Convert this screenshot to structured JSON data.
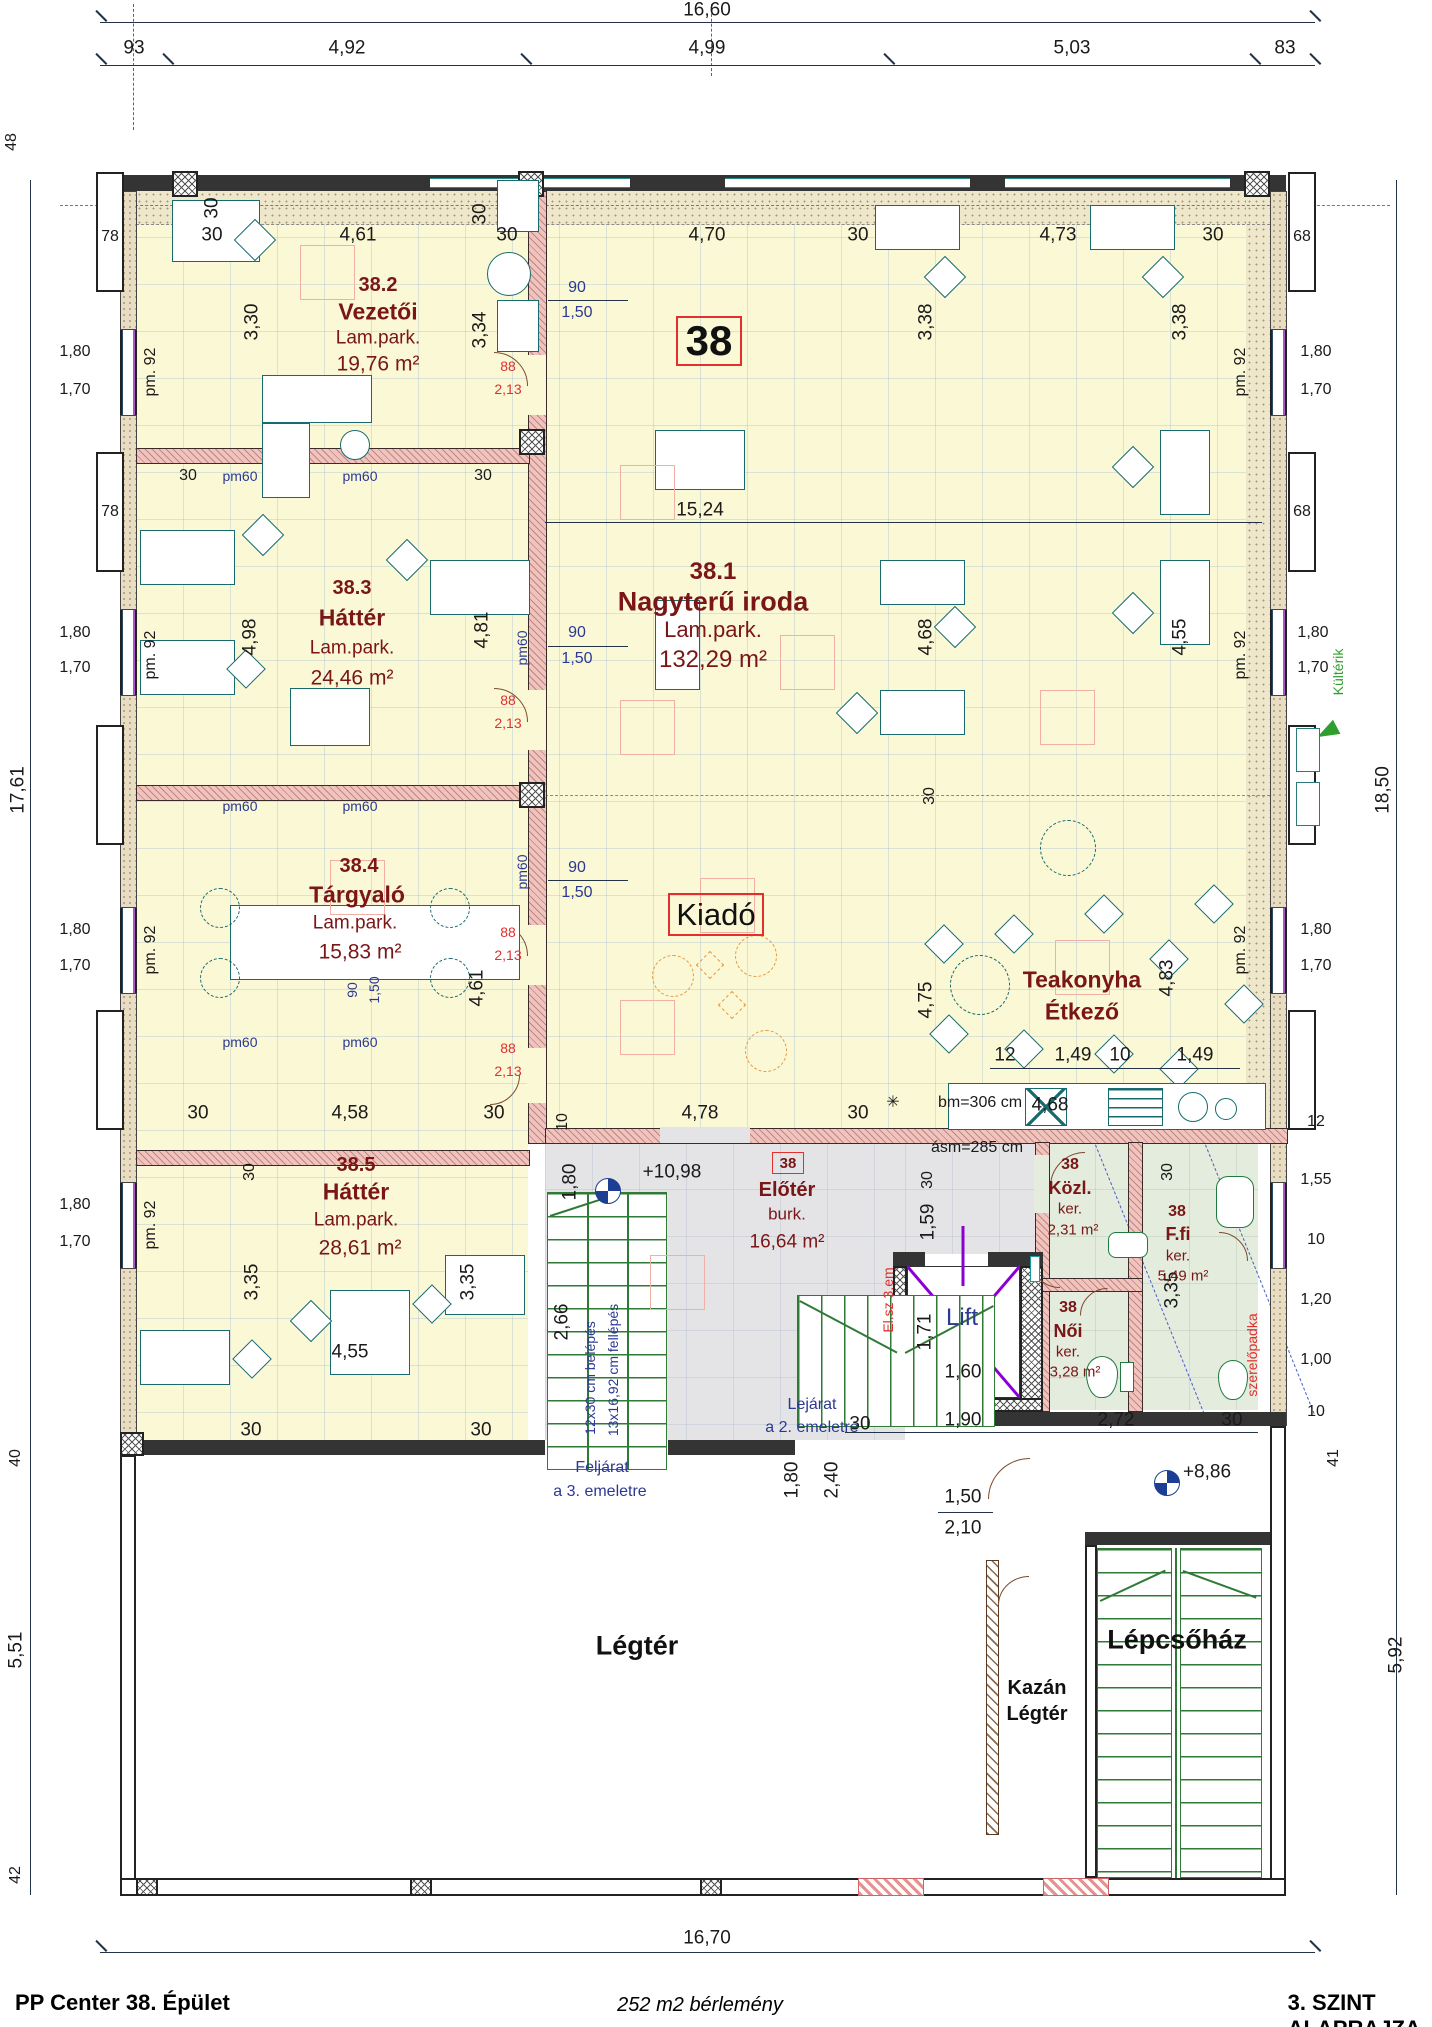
{
  "footer": {
    "left": "PP Center  38. Épület",
    "center": "252 m2 bérlemény",
    "right": "3. SZINT ALAPRAJZA  M=1:100"
  },
  "unit": {
    "big": "38"
  },
  "rooms": {
    "r381": {
      "num": "38.1",
      "name": "Nagyterű iroda",
      "floor": "Lam.park.",
      "area": "132,29 m²"
    },
    "r382": {
      "num": "38.2",
      "name": "Vezetői",
      "floor": "Lam.park.",
      "area": "19,76 m²"
    },
    "r383": {
      "num": "38.3",
      "name": "Háttér",
      "floor": "Lam.park.",
      "area": "24,46 m²"
    },
    "r384": {
      "num": "38.4",
      "name": "Tárgyaló",
      "floor": "Lam.park.",
      "area": "15,83 m²"
    },
    "r385": {
      "num": "38.5",
      "name": "Háttér",
      "floor": "Lam.park.",
      "area": "28,61 m²"
    },
    "kiado": {
      "name": "Kiadó"
    },
    "teakonyha": {
      "line1": "Teakonyha",
      "line2": "Étkező"
    },
    "eloter": {
      "tag": "38",
      "name": "Előtér",
      "floor": "burk.",
      "area": "16,64 m²"
    },
    "kozl": {
      "tag": "38",
      "name": "Közl.",
      "type": "ker.",
      "area": "2,31 m²"
    },
    "noi": {
      "tag": "38",
      "name": "Női",
      "type": "ker.",
      "area": "3,28 m²"
    },
    "ffi": {
      "tag": "38",
      "name": "F.fi",
      "type": "ker.",
      "area": "5,49 m²"
    },
    "lift": {
      "name": "Lift"
    },
    "legter": {
      "name": "Légtér"
    },
    "lepcsohaz": {
      "name": "Lépcsőház"
    },
    "kazan": {
      "line1": "Kazán",
      "line2": "Légtér"
    }
  },
  "dims": {
    "d1660": "16,60",
    "d93": "93",
    "d492": "4,92",
    "d499": "4,99",
    "d503": "5,03",
    "d83": "83",
    "d1670": "16,70",
    "d48": "48",
    "d42": "42",
    "d40": "40",
    "d41": "41",
    "d551": "5,51",
    "d592": "5,92",
    "d1761": "17,61",
    "d1850": "18,50",
    "d78": "78",
    "d68": "68",
    "d180": "1,80",
    "d170": "1,70",
    "d30": "30",
    "d461": "4,61",
    "d330": "3,30",
    "d334": "3,34",
    "d470": "4,70",
    "d473": "4,73",
    "d338": "3,38",
    "d1524": "15,24",
    "d498": "4,98",
    "d481": "4,81",
    "d468": "4,68",
    "d455": "4,55",
    "d475": "4,75",
    "d483": "4,83",
    "d12": "12",
    "d149": "1,49",
    "d10": "10",
    "d155": "1,55",
    "d120": "1,20",
    "d100": "1,00",
    "d458": "4,58",
    "d335": "3,35",
    "d266": "2,66",
    "d478": "4,78",
    "d159": "1,59",
    "d150": "1,50",
    "d210": "2,10",
    "d240": "2,40",
    "d190": "1,90",
    "d272": "2,72",
    "d171": "1,71",
    "d160": "1,60",
    "d90": "90",
    "d88": "88",
    "d213": "2,13"
  },
  "ann": {
    "pm92": "pm. 92",
    "pm60": "pm60",
    "lvl_up": "+10,98",
    "lvl_dn": "+8,86",
    "bm": "bm=306 cm",
    "asm": "ásm=285 cm",
    "felj1": "Feljárat",
    "felj2": "a 3. emeletre",
    "lej1": "Lejárat",
    "lej2": "a 2. emeletre",
    "belepes": "12x30 cm belépés",
    "fellepes": "13x16,92 cm fellépés",
    "kulterik": "Kültérik",
    "elsz": "El.sz 3.em",
    "szerelo": "szerelőpadka",
    "star": "✳"
  }
}
